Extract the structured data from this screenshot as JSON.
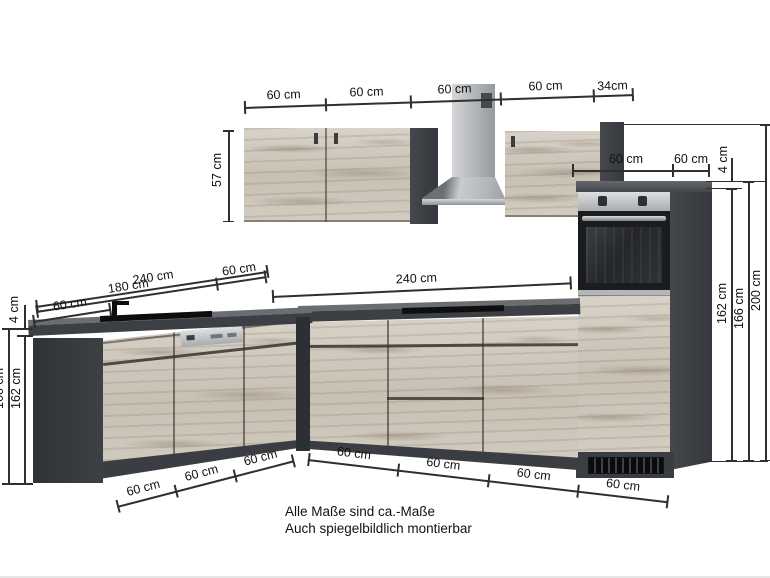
{
  "footer": {
    "line1": "Alle Maße sind ca.-Maße",
    "line2": "Auch spiegelbildlich montierbar"
  },
  "dims": {
    "top": [
      "60 cm",
      "60 cm",
      "60 cm",
      "60 cm",
      "34cm"
    ],
    "upper_height": "57 cm",
    "tall_top": [
      "60 cm",
      "60 cm"
    ],
    "gap_right": "4 cm",
    "gap_left": "4 cm",
    "right_heights": [
      "162 cm",
      "166 cm",
      "200 cm"
    ],
    "left_heights": [
      "162 cm",
      "166 cm"
    ],
    "left_run_total": "240 cm",
    "left_run_main": "180 cm",
    "left_run_corner": "60 cm",
    "left_run_sink": "60 cm",
    "right_run_total": "240 cm",
    "bottom_left": [
      "60 cm",
      "60 cm",
      "60 cm"
    ],
    "bottom_right": [
      "60 cm",
      "60 cm",
      "60 cm",
      "60 cm"
    ]
  },
  "colors": {
    "anthracite": "#3f4246",
    "wood": "#d8d2c8",
    "steel": "#c6c9cc",
    "cooktop": "#0d0e0f",
    "line": "#2f2f2f"
  }
}
